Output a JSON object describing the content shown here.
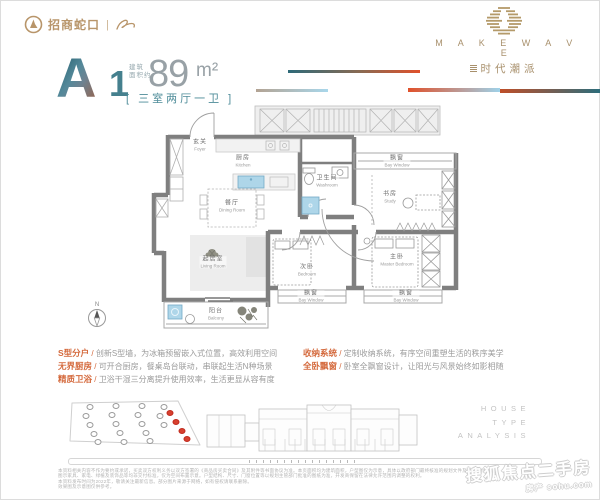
{
  "palette": {
    "gold": "#b8956a",
    "teal": "#3e7d8c",
    "orange": "#e0512b",
    "gray_area": "#98a1a6",
    "wall": "#7f7f7f",
    "fixture_blue": "#aed6e9",
    "marker_red": "#d7402f"
  },
  "header": {
    "brand_left": {
      "name": "招商蛇口",
      "divider": "|"
    },
    "brand_right": {
      "title": "M A K E   W A V E",
      "subtitle": "时代潮派"
    }
  },
  "unit": {
    "type_letter": "A",
    "type_number": "1",
    "area_prefix_line1": "建筑",
    "area_prefix_line2": "面积约",
    "area_value": "89",
    "area_unit": "m²",
    "layout_label": "[ 三室两厅一卫 ]"
  },
  "floorplan": {
    "compass_label": "N",
    "rooms": [
      {
        "id": "foyer",
        "cn": "玄关",
        "en": "Foyer",
        "x": 50,
        "y": 40
      },
      {
        "id": "kitchen",
        "cn": "厨房",
        "en": "Kitchen",
        "x": 93,
        "y": 56
      },
      {
        "id": "dining-room",
        "cn": "餐厅",
        "en": "Dining Room",
        "x": 82,
        "y": 101
      },
      {
        "id": "washroom",
        "cn": "卫生间",
        "en": "Washroom",
        "x": 177,
        "y": 76
      },
      {
        "id": "bay-window-study",
        "cn": "飘窗",
        "en": "Bay Window",
        "x": 247,
        "y": 56
      },
      {
        "id": "study",
        "cn": "书房",
        "en": "Study",
        "x": 240,
        "y": 92
      },
      {
        "id": "living-room",
        "cn": "起居室",
        "en": "Living Room",
        "x": 63,
        "y": 157
      },
      {
        "id": "bedroom",
        "cn": "次卧",
        "en": "Bedroom",
        "x": 157,
        "y": 165
      },
      {
        "id": "master-bedroom",
        "cn": "主卧",
        "en": "Master Bedroom",
        "x": 247,
        "y": 155
      },
      {
        "id": "bay-window-bedroom",
        "cn": "飘窗",
        "en": "Bay Window",
        "x": 161,
        "y": 191
      },
      {
        "id": "bay-window-master",
        "cn": "飘窗",
        "en": "Bay Window",
        "x": 256,
        "y": 191
      },
      {
        "id": "balcony",
        "cn": "阳台",
        "en": "Balcony",
        "x": 66,
        "y": 209
      }
    ]
  },
  "features_separator": "/",
  "features_left": [
    {
      "title": "S型分户",
      "desc": "创新S型墙，为冰箱预留嵌入式位置，高效利用空间"
    },
    {
      "title": "无界厨房",
      "desc": "可开合厨房，餐桌岛台联动，串联起生活N种场景"
    },
    {
      "title": "精质卫浴",
      "desc": "卫浴干湿三分离提升使用效率，生活更显从容有度"
    }
  ],
  "features_right": [
    {
      "title": "收纳系统",
      "desc": "定制收纳系统，有序空间重塑生活的秩序美学"
    },
    {
      "title": "全卧飘窗",
      "desc": "卧室全飘窗设计，让阳光与风景始终如影相随"
    }
  ],
  "footer": {
    "house_type_lines": [
      "HOUSE",
      "TYPE",
      "ANALYSIS"
    ],
    "disclaimer_lines": [
      "本资料相关内容不作为要约或承诺，买卖双方权利义务以双方签署的《商品房买卖合同》及其附件等书面协议为准。本页面积均为建筑面积，户型图仅为示意，具体以政府部门最终核准的规划文件及实际交付为准。",
      "图示家具、家电、绿植及装饰品等均非交付标准，仅为空间布置示意。户型结构、尺寸、门窗位置等以规划主管部门批准的图纸为准，开发商保留在法律允许范围内调整的权利。",
      "本资料发布时间为2022年，敬请关注最新信息。部分图片来源于网络，如有侵权请联系删除。",
      "效果图及示意图仅供参考。"
    ],
    "watermark_line1": "搜狐焦点二手房",
    "watermark_line2": "房产 sohu.com"
  },
  "site_plan": {
    "markers": [
      {
        "type": "gray",
        "x": 30,
        "y": 10
      },
      {
        "type": "gray",
        "x": 56,
        "y": 9
      },
      {
        "type": "gray",
        "x": 82,
        "y": 9
      },
      {
        "type": "gray",
        "x": 104,
        "y": 10
      },
      {
        "type": "gray",
        "x": 26,
        "y": 19
      },
      {
        "type": "gray",
        "x": 52,
        "y": 18
      },
      {
        "type": "gray",
        "x": 78,
        "y": 18
      },
      {
        "type": "gray",
        "x": 100,
        "y": 19
      },
      {
        "type": "gray",
        "x": 30,
        "y": 28
      },
      {
        "type": "gray",
        "x": 56,
        "y": 27
      },
      {
        "type": "gray",
        "x": 82,
        "y": 27
      },
      {
        "type": "gray",
        "x": 104,
        "y": 28
      },
      {
        "type": "gray",
        "x": 34,
        "y": 37
      },
      {
        "type": "gray",
        "x": 60,
        "y": 36
      },
      {
        "type": "gray",
        "x": 86,
        "y": 36
      },
      {
        "type": "gray",
        "x": 38,
        "y": 45
      },
      {
        "type": "gray",
        "x": 64,
        "y": 45
      },
      {
        "type": "gray",
        "x": 90,
        "y": 44
      },
      {
        "type": "red",
        "x": 110,
        "y": 16
      },
      {
        "type": "red",
        "x": 116,
        "y": 25
      },
      {
        "type": "red",
        "x": 122,
        "y": 34
      },
      {
        "type": "red",
        "x": 127,
        "y": 42
      }
    ]
  }
}
